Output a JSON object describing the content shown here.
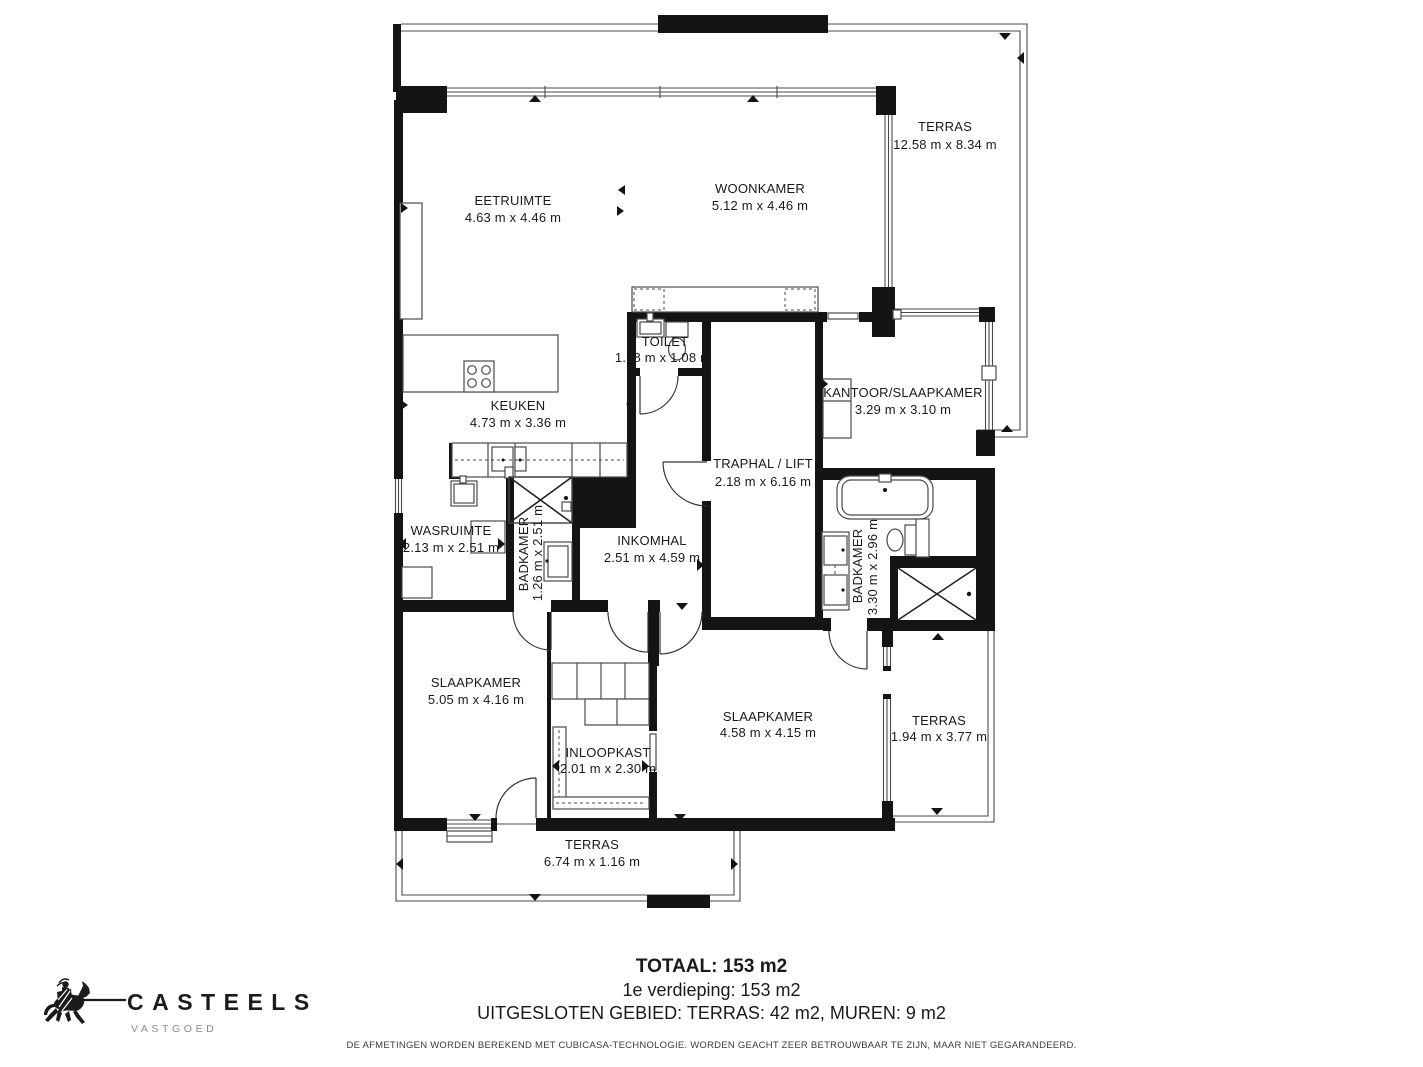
{
  "plan": {
    "rooms": [
      {
        "id": "terras-top",
        "name": "TERRAS",
        "dims": "12.58 m x 8.34 m"
      },
      {
        "id": "woonkamer",
        "name": "WOONKAMER",
        "dims": "5.12 m x 4.46 m"
      },
      {
        "id": "eetruimte",
        "name": "EETRUIMTE",
        "dims": "4.63 m x 4.46 m"
      },
      {
        "id": "keuken",
        "name": "KEUKEN",
        "dims": "4.73 m x 3.36 m"
      },
      {
        "id": "toilet",
        "name": "TOILET",
        "dims": "1.38 m x 1.08 m"
      },
      {
        "id": "kantoor-slaapkamer",
        "name": "KANTOOR/SLAAPKAMER",
        "dims": "3.29 m x 3.10 m"
      },
      {
        "id": "traphal-lift",
        "name": "TRAPHAL / LIFT",
        "dims": "2.18 m x 6.16 m"
      },
      {
        "id": "wasruimte",
        "name": "WASRUIMTE",
        "dims": "2.13 m x 2.51 m"
      },
      {
        "id": "badkamer-links",
        "name": "BADKAMER",
        "dims": "1.26 m x 2.51 m"
      },
      {
        "id": "inkomhal",
        "name": "INKOMHAL",
        "dims": "2.51 m x 4.59 m"
      },
      {
        "id": "badkamer-rechts",
        "name": "BADKAMER",
        "dims": "3.30 m x 2.96 m"
      },
      {
        "id": "slaapkamer-links",
        "name": "SLAAPKAMER",
        "dims": "5.05 m x 4.16 m"
      },
      {
        "id": "inloopkast",
        "name": "INLOOPKAST",
        "dims": "2.01 m x 2.30 m"
      },
      {
        "id": "slaapkamer-rechts",
        "name": "SLAAPKAMER",
        "dims": "4.58 m x 4.15 m"
      },
      {
        "id": "terras-rechts",
        "name": "TERRAS",
        "dims": "1.94 m x 3.77 m"
      },
      {
        "id": "terras-onder",
        "name": "TERRAS",
        "dims": "6.74 m x 1.16 m"
      }
    ]
  },
  "summary": {
    "total": "TOTAAL: 153 m2",
    "floor": "1e verdieping: 153 m2",
    "excluded": "UITGESLOTEN GEBIED: TERRAS: 42 m2, MUREN: 9 m2"
  },
  "disclaimer": "DE AFMETINGEN WORDEN BEREKEND MET CUBICASA-TECHNOLOGIE. WORDEN GEACHT ZEER BETROUWBAAR TE ZIJN, MAAR NIET GEGARANDEERD.",
  "logo": {
    "brand": "CASTEELS",
    "tagline": "VASTGOED",
    "icon": "knight-on-horse-icon"
  },
  "colors": {
    "wall": "#141414",
    "line": "#4a4a4a",
    "text": "#1a1a1a",
    "muted": "#8d8d8d",
    "background": "#ffffff"
  }
}
